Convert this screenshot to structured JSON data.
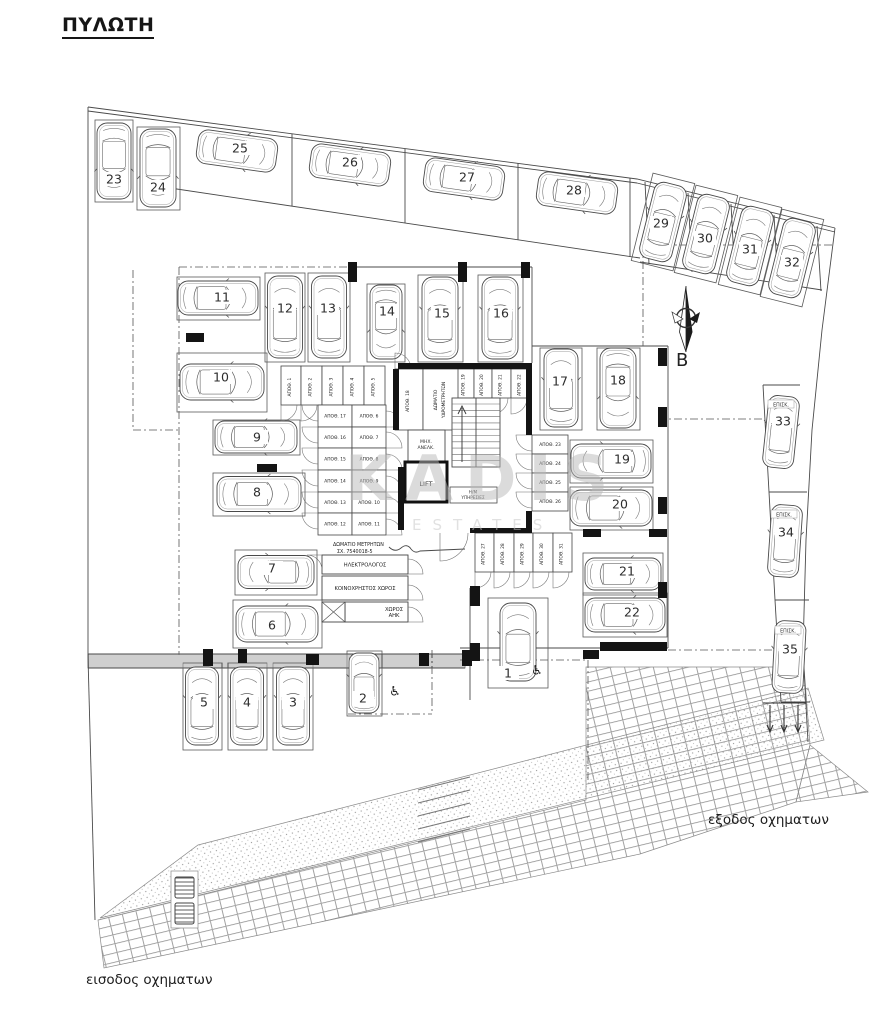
{
  "title": "ΠΥΛΩΤΗ",
  "watermark": {
    "line1": "KADIS",
    "line2": "ESTATES"
  },
  "north": {
    "label": "B"
  },
  "site_labels": {
    "entrance": "εισοδος οχηματων",
    "exit": "εξοδος οχηματων"
  },
  "visitor_label": "ΕΠΙΣΚ.",
  "storage_prefix": "ΑΠΟΘ.",
  "accessible_icon": "♿",
  "core": {
    "lift": "LIFT",
    "mech_lines": [
      "ΜΗΧ.",
      "ΑΝΕΛΚ."
    ],
    "aux_lines": [
      "Η/Μ",
      "ΥΠΗΡΕΣΙΕΣ"
    ],
    "water_room_lines": [
      "ΔΩΜΑΤΙΟ",
      "ΥΔΡΟΜΕΤΡΗΤΩΝ"
    ],
    "meter_lines": [
      "ΔΩΜΑΤΙΟ ΜΕΤΡΗΤΩΝ",
      "ΣΧ. 7540018-5"
    ]
  },
  "rooms": [
    {
      "name": "electrical-room",
      "lines": [
        "ΗΛΕΚΤΡΟΛΟΓΟΣ"
      ],
      "box": [
        322,
        555,
        408,
        574
      ]
    },
    {
      "name": "common-area",
      "lines": [
        "ΚΟΙΝΟΧΡΗΣΤΟΣ ΧΩΡΟΣ"
      ],
      "box": [
        322,
        576,
        408,
        600
      ]
    },
    {
      "name": "ahk-room",
      "lines": [
        "ΧΩΡΟΣ",
        "ΑΗΚ"
      ],
      "box": [
        345,
        602,
        408,
        622
      ]
    }
  ],
  "parking": [
    {
      "n": "1",
      "cx": 518,
      "cy": 642,
      "l": 78,
      "w": 36,
      "r": -90,
      "stall": [
        488,
        598,
        548,
        688
      ],
      "nx": 508,
      "ny": 673,
      "acc": [
        537,
        670
      ]
    },
    {
      "n": "2",
      "cx": 364,
      "cy": 683,
      "l": 60,
      "w": 30,
      "r": -90,
      "stall": [
        347,
        651,
        382,
        716
      ],
      "nx": 363,
      "ny": 698,
      "acc": [
        395,
        691
      ]
    },
    {
      "n": "3",
      "cx": 293,
      "cy": 706,
      "l": 78,
      "w": 33,
      "r": -90,
      "stall": [
        273,
        663,
        313,
        750
      ],
      "nx": 293,
      "ny": 702
    },
    {
      "n": "4",
      "cx": 247,
      "cy": 706,
      "l": 78,
      "w": 33,
      "r": -90,
      "stall": [
        228,
        663,
        267,
        750
      ],
      "nx": 247,
      "ny": 702
    },
    {
      "n": "5",
      "cx": 202,
      "cy": 706,
      "l": 78,
      "w": 33,
      "r": -90,
      "stall": [
        183,
        663,
        222,
        750
      ],
      "nx": 204,
      "ny": 702
    },
    {
      "n": "6",
      "cx": 277,
      "cy": 624,
      "l": 82,
      "w": 36,
      "r": 0,
      "stall": [
        233,
        600,
        322,
        648
      ],
      "nx": 272,
      "ny": 625
    },
    {
      "n": "7",
      "cx": 276,
      "cy": 572,
      "l": 76,
      "w": 33,
      "r": 180,
      "stall": [
        235,
        550,
        317,
        595
      ],
      "nx": 272,
      "ny": 568
    },
    {
      "n": "8",
      "cx": 259,
      "cy": 494,
      "l": 84,
      "w": 35,
      "r": 0,
      "stall": [
        213,
        473,
        305,
        516
      ],
      "nx": 257,
      "ny": 492
    },
    {
      "n": "9",
      "cx": 256,
      "cy": 437,
      "l": 82,
      "w": 32,
      "r": 0,
      "stall": [
        213,
        420,
        300,
        455
      ],
      "nx": 257,
      "ny": 437
    },
    {
      "n": "10",
      "cx": 222,
      "cy": 382,
      "l": 84,
      "w": 36,
      "r": 0,
      "stall": [
        177,
        353,
        267,
        412
      ],
      "nx": 221,
      "ny": 377
    },
    {
      "n": "11",
      "cx": 218,
      "cy": 298,
      "l": 80,
      "w": 34,
      "r": 0,
      "stall": [
        177,
        277,
        260,
        320
      ],
      "nx": 222,
      "ny": 297
    },
    {
      "n": "12",
      "cx": 285,
      "cy": 317,
      "l": 82,
      "w": 35,
      "r": -90,
      "stall": [
        265,
        273,
        305,
        362
      ],
      "nx": 285,
      "ny": 308
    },
    {
      "n": "13",
      "cx": 329,
      "cy": 317,
      "l": 82,
      "w": 35,
      "r": -90,
      "stall": [
        308,
        273,
        350,
        362
      ],
      "nx": 328,
      "ny": 308
    },
    {
      "n": "14",
      "cx": 386,
      "cy": 322,
      "l": 74,
      "w": 32,
      "r": 90,
      "stall": [
        367,
        284,
        405,
        362
      ],
      "nx": 387,
      "ny": 311
    },
    {
      "n": "15",
      "cx": 440,
      "cy": 318,
      "l": 82,
      "w": 36,
      "r": -90,
      "stall": [
        418,
        275,
        463,
        362
      ],
      "nx": 442,
      "ny": 313
    },
    {
      "n": "16",
      "cx": 500,
      "cy": 318,
      "l": 82,
      "w": 36,
      "r": -90,
      "stall": [
        478,
        275,
        523,
        362
      ],
      "nx": 501,
      "ny": 313
    },
    {
      "n": "17",
      "cx": 561,
      "cy": 388,
      "l": 78,
      "w": 34,
      "r": -90,
      "stall": [
        540,
        348,
        582,
        430
      ],
      "nx": 560,
      "ny": 381
    },
    {
      "n": "18",
      "cx": 618,
      "cy": 388,
      "l": 80,
      "w": 36,
      "r": 90,
      "stall": [
        597,
        348,
        640,
        430
      ],
      "nx": 618,
      "ny": 380
    },
    {
      "n": "19",
      "cx": 611,
      "cy": 461,
      "l": 80,
      "w": 34,
      "r": 180,
      "stall": [
        570,
        440,
        653,
        483
      ],
      "nx": 622,
      "ny": 459
    },
    {
      "n": "20",
      "cx": 611,
      "cy": 508,
      "l": 82,
      "w": 36,
      "r": 0,
      "stall": [
        570,
        487,
        653,
        530
      ],
      "nx": 620,
      "ny": 504
    },
    {
      "n": "21",
      "cx": 623,
      "cy": 574,
      "l": 76,
      "w": 32,
      "r": 0,
      "stall": [
        583,
        553,
        663,
        595
      ],
      "nx": 627,
      "ny": 571
    },
    {
      "n": "22",
      "cx": 625,
      "cy": 615,
      "l": 80,
      "w": 34,
      "r": 0,
      "stall": [
        583,
        593,
        667,
        637
      ],
      "nx": 632,
      "ny": 612
    },
    {
      "n": "23",
      "cx": 114,
      "cy": 161,
      "l": 76,
      "w": 34,
      "r": 90,
      "stall": [
        95,
        120,
        133,
        202
      ],
      "nx": 114,
      "ny": 179
    },
    {
      "n": "24",
      "cx": 158,
      "cy": 168,
      "l": 78,
      "w": 36,
      "r": 90,
      "stall": [
        137,
        127,
        180,
        210
      ],
      "nx": 158,
      "ny": 187
    },
    {
      "n": "25",
      "cx": 237,
      "cy": 151,
      "l": 80,
      "w": 34,
      "r": 8,
      "nx": 240,
      "ny": 148
    },
    {
      "n": "26",
      "cx": 350,
      "cy": 165,
      "l": 80,
      "w": 34,
      "r": 8,
      "nx": 350,
      "ny": 162
    },
    {
      "n": "27",
      "cx": 464,
      "cy": 179,
      "l": 80,
      "w": 34,
      "r": 8,
      "nx": 467,
      "ny": 177
    },
    {
      "n": "28",
      "cx": 577,
      "cy": 193,
      "l": 80,
      "w": 34,
      "r": 8,
      "nx": 574,
      "ny": 190
    },
    {
      "n": "29",
      "cx": 663,
      "cy": 222,
      "l": 78,
      "w": 33,
      "r": -76,
      "spad": 1,
      "nx": 661,
      "ny": 223
    },
    {
      "n": "30",
      "cx": 706,
      "cy": 234,
      "l": 78,
      "w": 33,
      "r": -76,
      "spad": 1,
      "nx": 705,
      "ny": 238
    },
    {
      "n": "31",
      "cx": 750,
      "cy": 246,
      "l": 78,
      "w": 33,
      "r": -76,
      "spad": 1,
      "nx": 750,
      "ny": 249
    },
    {
      "n": "32",
      "cx": 792,
      "cy": 258,
      "l": 78,
      "w": 33,
      "r": -76,
      "spad": 1,
      "nx": 792,
      "ny": 262
    },
    {
      "n": "33",
      "cx": 781,
      "cy": 432,
      "l": 72,
      "w": 31,
      "r": -84,
      "vis": 1,
      "vlx": 781,
      "vly": 404,
      "nx": 783,
      "ny": 421
    },
    {
      "n": "34",
      "cx": 785,
      "cy": 541,
      "l": 72,
      "w": 31,
      "r": -86,
      "vis": 1,
      "vlx": 784,
      "vly": 514,
      "nx": 786,
      "ny": 532
    },
    {
      "n": "35",
      "cx": 789,
      "cy": 657,
      "l": 72,
      "w": 31,
      "r": -87,
      "vis": 1,
      "vlx": 788,
      "vly": 630,
      "nx": 790,
      "ny": 649
    }
  ],
  "storage": [
    {
      "n": "1",
      "box": [
        281,
        366,
        301,
        405
      ],
      "v": 1,
      "door": "b"
    },
    {
      "n": "2",
      "box": [
        301,
        366,
        322,
        405
      ],
      "v": 1,
      "door": "b"
    },
    {
      "n": "3",
      "box": [
        322,
        366,
        343,
        405
      ],
      "v": 1,
      "door": "b"
    },
    {
      "n": "4",
      "box": [
        343,
        366,
        364,
        405
      ],
      "v": 1,
      "door": "b"
    },
    {
      "n": "5",
      "box": [
        364,
        366,
        385,
        405
      ],
      "v": 1,
      "door": "b"
    },
    {
      "n": "17",
      "box": [
        318,
        405,
        352,
        427
      ],
      "v": 0,
      "door": "l"
    },
    {
      "n": "6",
      "box": [
        352,
        405,
        386,
        427
      ],
      "v": 0,
      "door": "r"
    },
    {
      "n": "16",
      "box": [
        318,
        427,
        352,
        448
      ],
      "v": 0,
      "door": "l"
    },
    {
      "n": "7",
      "box": [
        352,
        427,
        386,
        448
      ],
      "v": 0,
      "door": "r"
    },
    {
      "n": "15",
      "box": [
        318,
        448,
        352,
        470
      ],
      "v": 0,
      "door": "l"
    },
    {
      "n": "8",
      "box": [
        352,
        448,
        386,
        470
      ],
      "v": 0,
      "door": "r"
    },
    {
      "n": "14",
      "box": [
        318,
        470,
        352,
        492
      ],
      "v": 0,
      "door": "l"
    },
    {
      "n": "9",
      "box": [
        352,
        470,
        386,
        492
      ],
      "v": 0,
      "door": "r"
    },
    {
      "n": "13",
      "box": [
        318,
        492,
        352,
        513
      ],
      "v": 0,
      "door": "l"
    },
    {
      "n": "10",
      "box": [
        352,
        492,
        386,
        513
      ],
      "v": 0,
      "door": "r"
    },
    {
      "n": "12",
      "box": [
        318,
        513,
        352,
        535
      ],
      "v": 0,
      "door": "l"
    },
    {
      "n": "11",
      "box": [
        352,
        513,
        386,
        535
      ],
      "v": 0,
      "door": "r"
    },
    {
      "n": "18",
      "box": [
        395,
        369,
        423,
        430
      ],
      "v": 1,
      "door": "t"
    },
    {
      "n": "19",
      "box": [
        455,
        369,
        474,
        398
      ],
      "v": 1,
      "door": "b"
    },
    {
      "n": "20",
      "box": [
        474,
        369,
        492,
        398
      ],
      "v": 1,
      "door": "b"
    },
    {
      "n": "21",
      "box": [
        492,
        369,
        511,
        398
      ],
      "v": 1,
      "door": "b"
    },
    {
      "n": "22",
      "box": [
        511,
        369,
        530,
        398
      ],
      "v": 1,
      "door": "b"
    },
    {
      "n": "23",
      "box": [
        532,
        435,
        568,
        454
      ],
      "v": 0,
      "door": "l"
    },
    {
      "n": "24",
      "box": [
        532,
        454,
        568,
        473
      ],
      "v": 0,
      "door": "l"
    },
    {
      "n": "25",
      "box": [
        532,
        473,
        568,
        492
      ],
      "v": 0,
      "door": "l"
    },
    {
      "n": "26",
      "box": [
        532,
        492,
        568,
        511
      ],
      "v": 0,
      "door": "l"
    },
    {
      "n": "27",
      "box": [
        475,
        533,
        494,
        572
      ],
      "v": 1,
      "door": "b"
    },
    {
      "n": "28",
      "box": [
        494,
        533,
        514,
        572
      ],
      "v": 1,
      "door": "b"
    },
    {
      "n": "29",
      "box": [
        514,
        533,
        533,
        572
      ],
      "v": 1,
      "door": "b"
    },
    {
      "n": "30",
      "box": [
        533,
        533,
        553,
        572
      ],
      "v": 1,
      "door": "b"
    },
    {
      "n": "31",
      "box": [
        553,
        533,
        572,
        572
      ],
      "v": 1,
      "door": "b"
    }
  ]
}
